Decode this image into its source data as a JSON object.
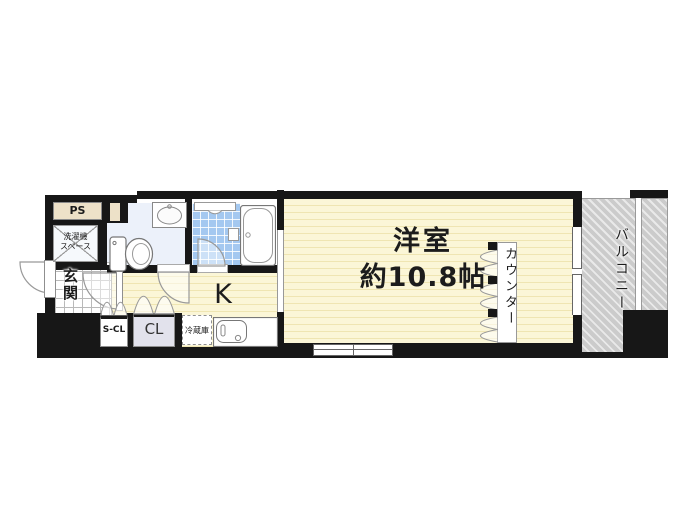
{
  "rooms": {
    "main_room": {
      "name": "洋室",
      "size": "約10.8帖"
    },
    "kitchen": {
      "label": "K"
    },
    "balcony": {
      "label": "バルコニー"
    },
    "counter": {
      "label": "カウンター"
    },
    "entrance": {
      "label": "玄関"
    },
    "pipe_space": {
      "label": "PS"
    },
    "washing_machine": {
      "line1": "洗濯機",
      "line2": "スペース"
    },
    "shoes_closet": {
      "label": "S-CL"
    },
    "closet": {
      "label": "CL"
    },
    "refrigerator": {
      "label": "冷蔵庫"
    }
  },
  "colors": {
    "wall": "#171717",
    "room_fill": "#FBF6D7",
    "room_stripe": "#EFE5B2",
    "bath_tile": "#A4C8F0",
    "toilet_floor": "#ECF1FA",
    "ps_fill": "#EDE1C8",
    "closet_fill": "#E2E2EC",
    "balcony_fill": "#CBCBCB"
  }
}
